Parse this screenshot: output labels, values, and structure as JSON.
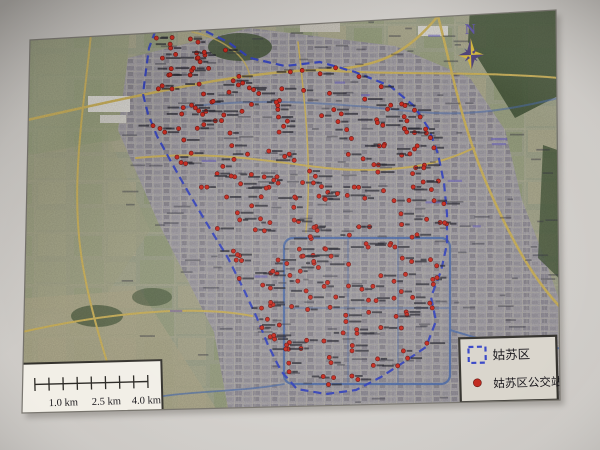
{
  "photo": {
    "background_center": "#dbd8d4",
    "background_edge": "#bdbab6"
  },
  "map": {
    "corners": "30,40 556,10 560,400 22,413",
    "base_color": "#9da189",
    "urban_color": "#a19da5",
    "road_color": "#cdb35c",
    "river_color": "#4f6fae",
    "forest_color": "#46573b",
    "boundary_color": "#3544c6",
    "boundary_points": "155,32 180,27 205,31 228,42 250,58 285,66 320,62 355,72 390,86 414,106 429,129 438,154 444,183 447,214 447,244 441,271 431,297 436,321 426,347 404,362 381,377 356,390 326,394 297,389 281,371 268,345 257,318 244,290 228,258 212,232 197,207 183,183 169,158 157,136 148,114 143,94 146,70 149,48",
    "urban_points": "128,58 250,28 395,46 470,78 505,130 522,200 546,262 560,302 560,430 232,430 214,332 158,222 118,130",
    "bus_stops": {
      "count": 300,
      "seed": 11,
      "dot_color": "#d42a1e",
      "dot_edge": "#6b1410",
      "label_color": "#23232e"
    },
    "street_labels": {
      "count": 170,
      "seed": 5,
      "color": "#3a3a44"
    },
    "place_labels": {
      "count": 12,
      "seed": 3,
      "color": "#6a63c0"
    }
  },
  "compass": {
    "north_label": "N",
    "light_color": "#d2b43a",
    "dark_color": "#4c4078",
    "label_color": "#5a4fa0"
  },
  "scale_bar": {
    "segments": 8,
    "labels": [
      "1.0 km",
      "2.5 km",
      "4.0 km"
    ]
  },
  "legend": {
    "items": [
      {
        "symbol": "district-boundary",
        "label": "姑苏区"
      },
      {
        "symbol": "bus-station-dot",
        "label": "姑苏区公交站"
      }
    ]
  }
}
